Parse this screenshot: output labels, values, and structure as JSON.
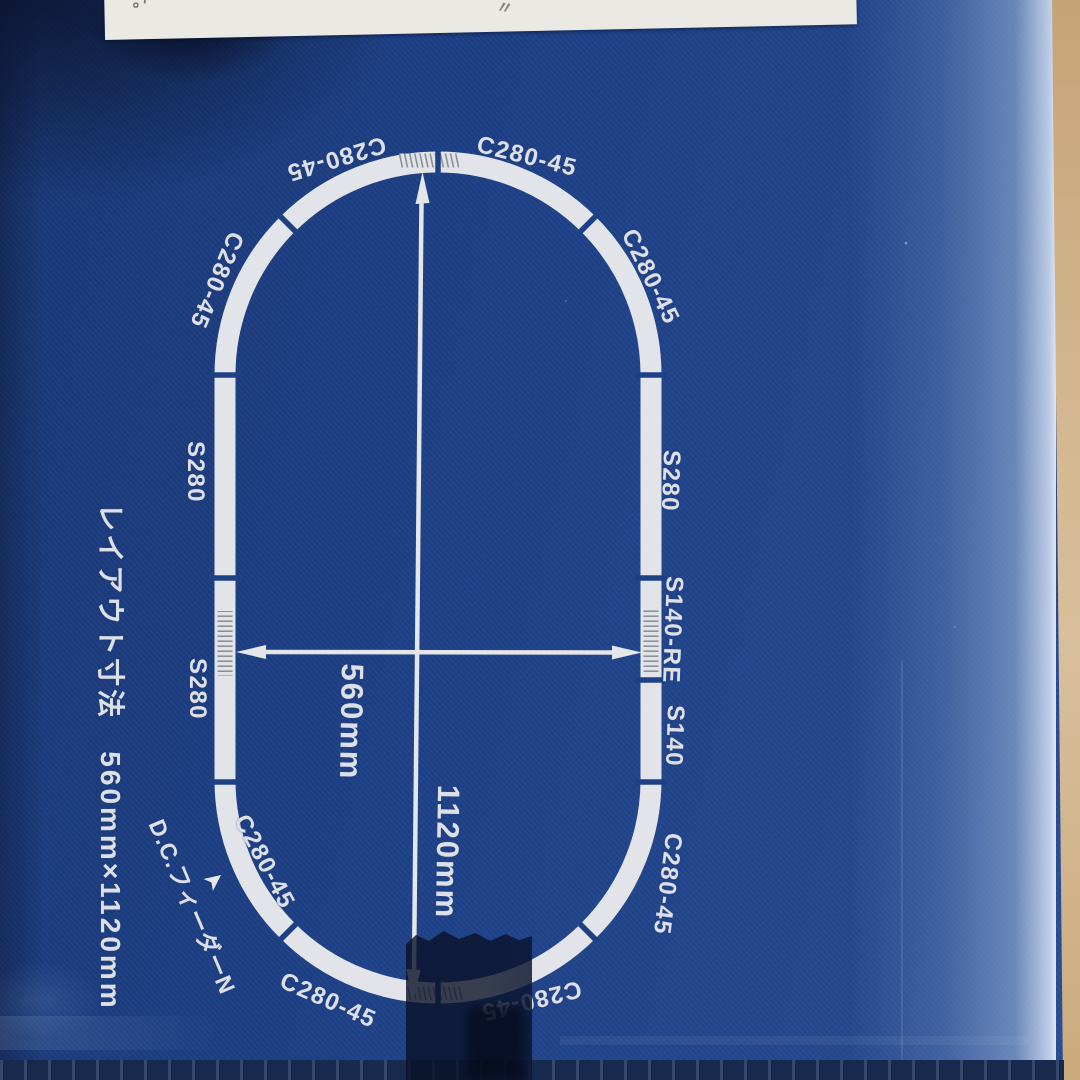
{
  "photo": {
    "handwriting": {
      "left_mark": "す。",
      "ditto_mark": "〃"
    },
    "colors": {
      "box_blue": "#1d4086",
      "ring_white": "#e8e9ec",
      "cardboard_tan": "#cfae80",
      "tape_dark": "#0c1430",
      "dark_band": "#17294d",
      "label_white": "#dde0e8"
    }
  },
  "diagram": {
    "caption": "レイアウト寸法　560mm×1120mm",
    "feeder": {
      "label": "D.C.フィーダーN",
      "arrow_icon": "➤"
    },
    "dimensions": {
      "width_label": "560mm",
      "height_label": "1120mm"
    },
    "track_pieces": {
      "top_left_curve": "C280-45",
      "top_right_curve": "C280-45",
      "ne_curve": "C280-45",
      "right_straight_s280": "S280",
      "right_rerailer": "S140-RE",
      "right_straight_s140": "S140",
      "se_curve": "C280-45",
      "bottom_right_curve": "C280-45",
      "bottom_left_curve": "C280-45",
      "sw_curve": "C280-45",
      "nw_curve": "C280-45",
      "left_straight_upper": "S280",
      "left_straight_lower": "S280"
    }
  }
}
